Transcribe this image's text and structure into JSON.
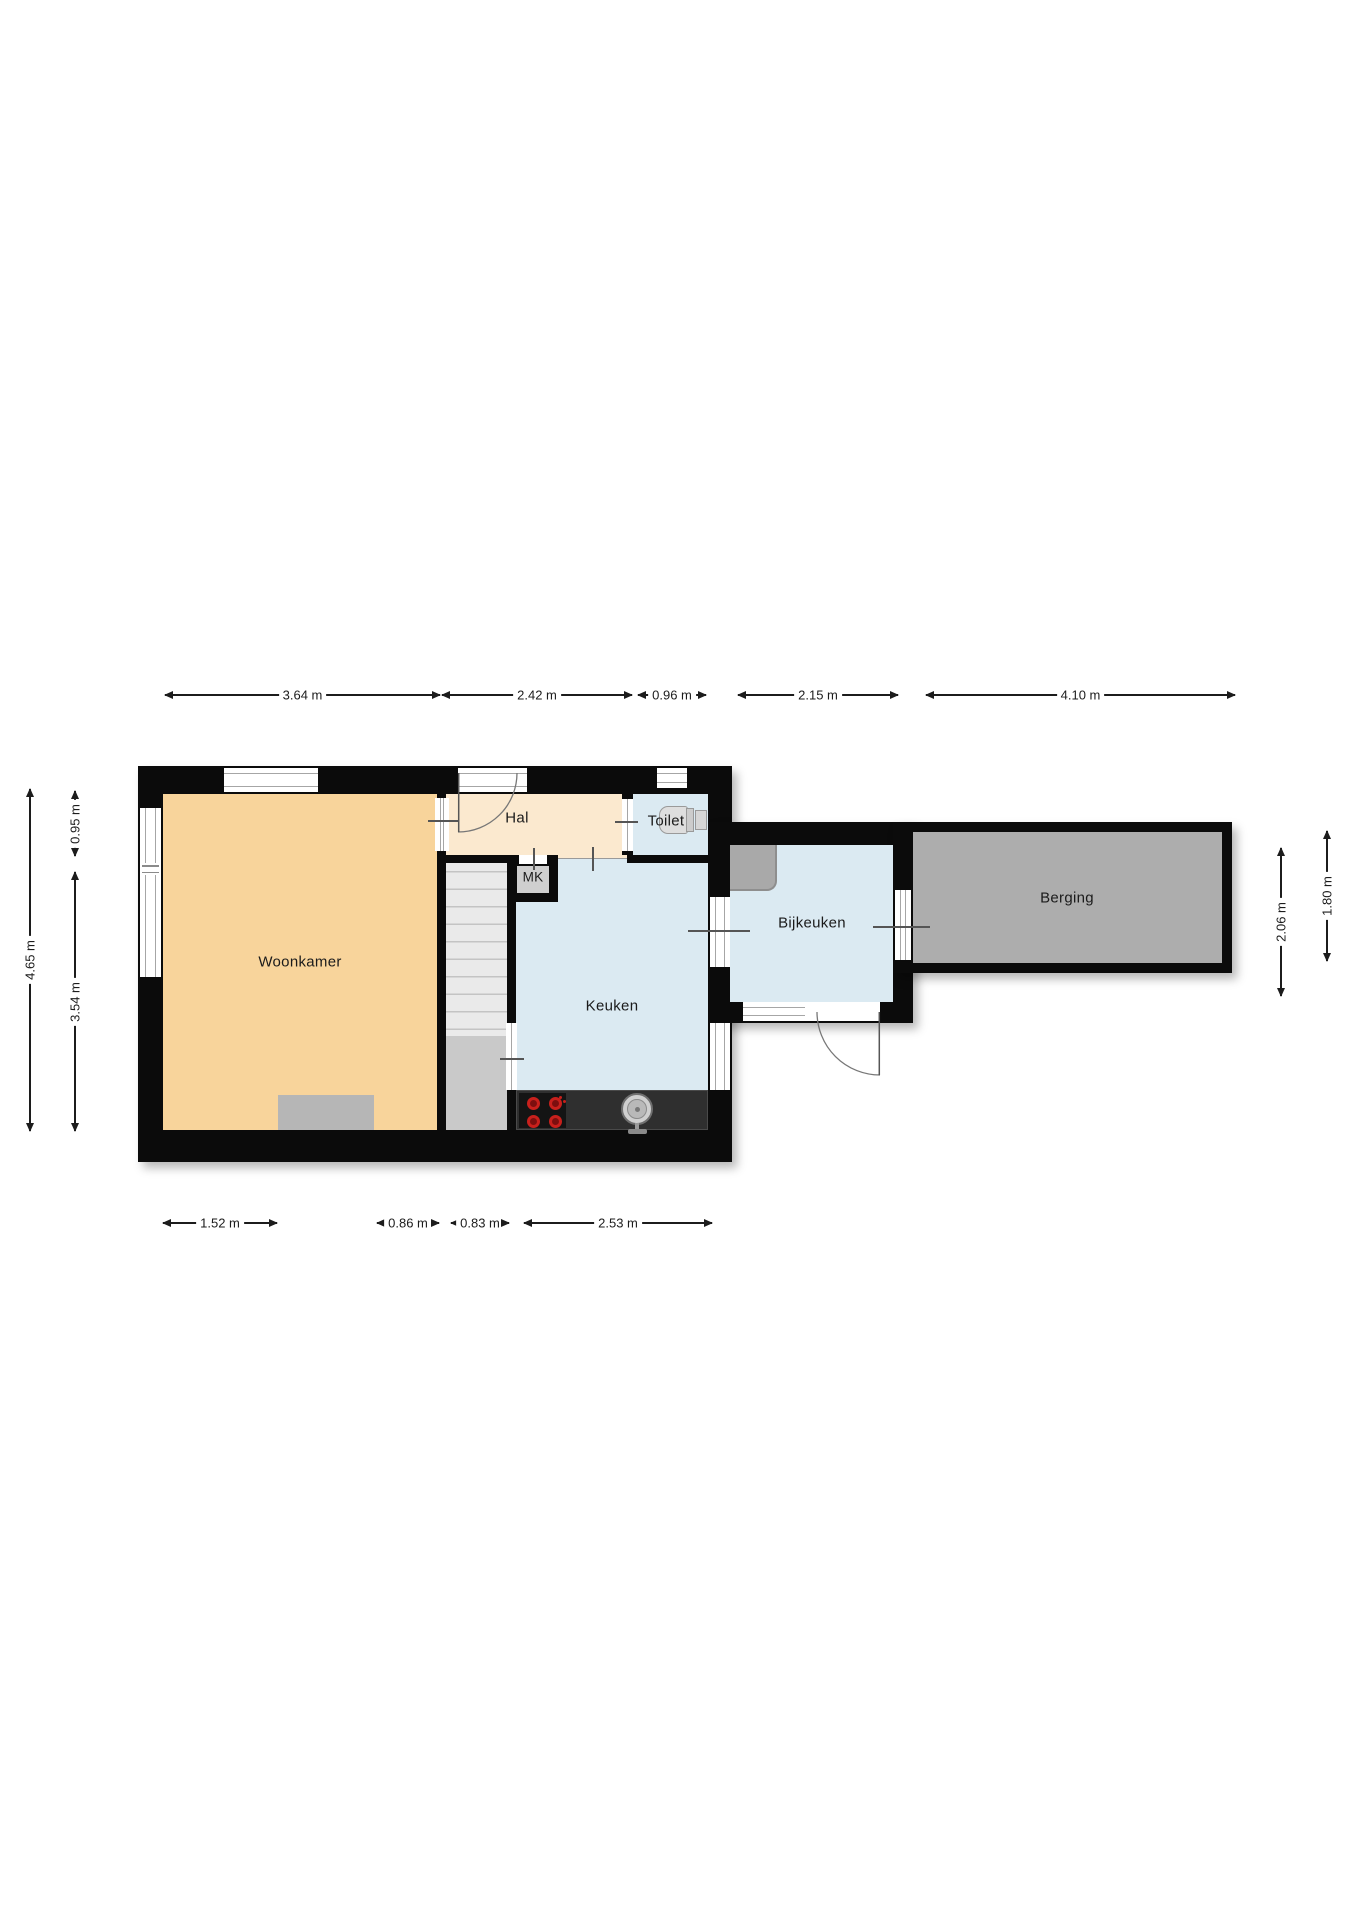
{
  "rooms": {
    "woonkamer": {
      "label": "Woonkamer"
    },
    "hal": {
      "label": "Hal"
    },
    "toilet": {
      "label": "Toilet"
    },
    "mk": {
      "label": "MK"
    },
    "keuken": {
      "label": "Keuken"
    },
    "bijkeuken": {
      "label": "Bijkeuken"
    },
    "berging": {
      "label": "Berging"
    }
  },
  "dimensions": {
    "unit": "m",
    "top": [
      "3.64 m",
      "2.42 m",
      "0.96 m",
      "2.15 m",
      "4.10 m"
    ],
    "bottom": [
      "1.52 m",
      "0.86 m",
      "0.83 m",
      "2.53 m"
    ],
    "left": [
      "4.65 m",
      "0.95 m",
      "3.54 m"
    ],
    "right": [
      "2.06 m",
      "1.80 m"
    ]
  },
  "colors": {
    "wall": "#0b0b0b",
    "woonkamer_fill": "#F8D49B",
    "hal_fill": "#FBE9CF",
    "wet_room_fill": "#DBEAF2",
    "berging_fill": "#ADADAD",
    "stairs_fill": "#EAEAEA",
    "stairs_landing_fill": "#C9C9C9",
    "mk_fill": "#CFCFCF",
    "counter": "#2F2F2F",
    "stove": "#141414",
    "burner_red": "#C8201C",
    "furniture_gray": "#B6B6B6",
    "appliance_gray": "#A9A9A9"
  }
}
